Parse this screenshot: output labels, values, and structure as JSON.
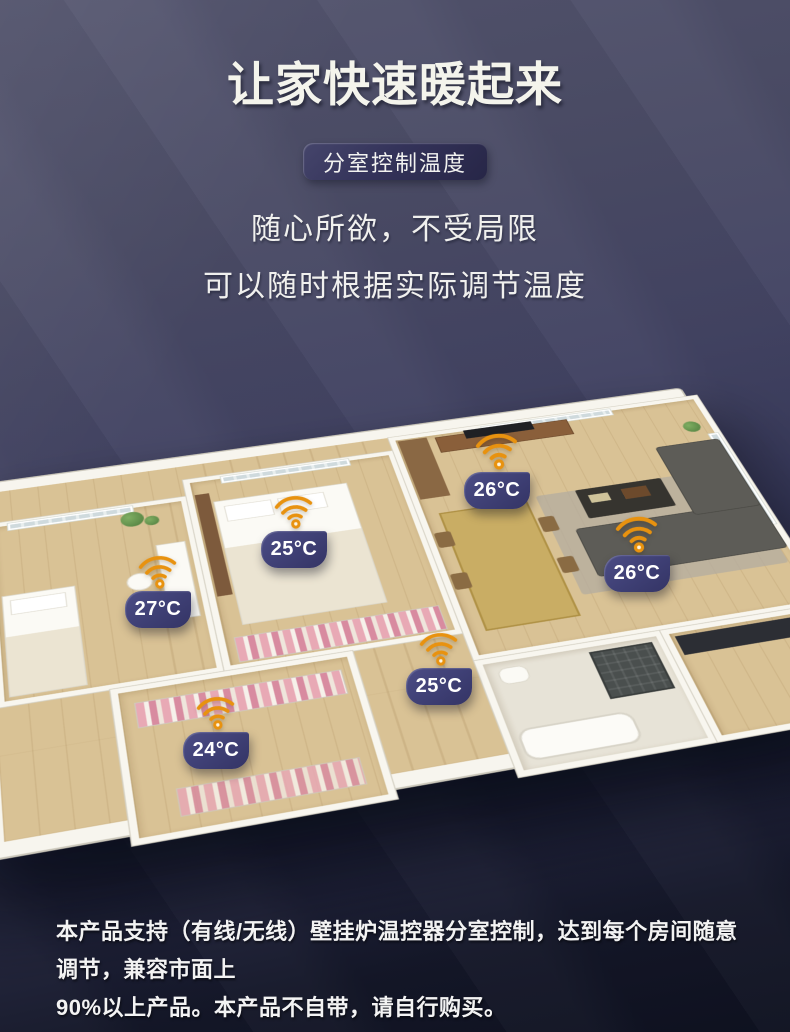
{
  "header": {
    "title": "让家快速暖起来",
    "badge": "分室控制温度",
    "subtitle_line1": "随心所欲，不受局限",
    "subtitle_line2": "可以随时根据实际调节温度"
  },
  "floorplan": {
    "sensors": [
      {
        "room": "bedroom-left",
        "temp": "27°C"
      },
      {
        "room": "bedroom-middle",
        "temp": "25°C"
      },
      {
        "room": "living-room-upper",
        "temp": "26°C"
      },
      {
        "room": "living-room-right",
        "temp": "26°C"
      },
      {
        "room": "bathroom",
        "temp": "25°C"
      },
      {
        "room": "cloakroom",
        "temp": "24°C"
      }
    ],
    "colors": {
      "wifi_accent": "#E8920F",
      "bubble_indigo": "#3E3F74"
    }
  },
  "footer": {
    "line1": "本产品支持（有线/无线）壁挂炉温控器分室控制，达到每个房间随意调节，兼容市面上",
    "line2": "90%以上产品。本产品不自带，请自行购买。"
  }
}
